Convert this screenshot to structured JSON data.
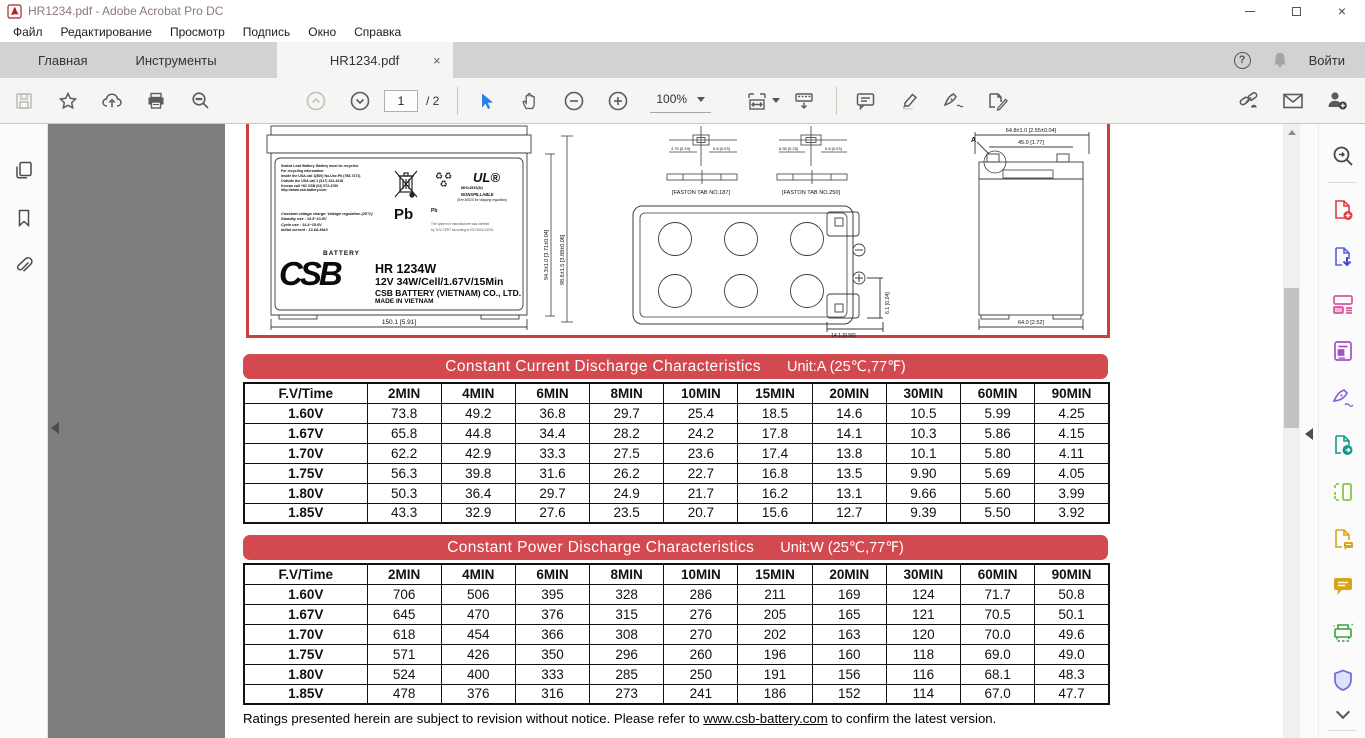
{
  "window": {
    "title": "HR1234.pdf - Adobe Acrobat Pro DC"
  },
  "icons": {
    "close_window": "×",
    "tab_close": "×",
    "help": "?"
  },
  "menu": {
    "items": [
      "Файл",
      "Редактирование",
      "Просмотр",
      "Подпись",
      "Окно",
      "Справка"
    ]
  },
  "tabbar": {
    "tabs": [
      {
        "label": "Главная"
      },
      {
        "label": "Инструменты"
      },
      {
        "label": "HR1234.pdf"
      }
    ],
    "sign_in": "Войти"
  },
  "toolbar": {
    "page_current": "1",
    "page_total": "/ 2",
    "zoom_level": "100%"
  },
  "document": {
    "drawing": {
      "label": {
        "recycle_lines": [
          "Sealed Lead Battery. Battery must be recycled.",
          "For recycling information:",
          "Inside the USA call 1(800) No-Use-Pb (768-7372)",
          "Outside the USA call 1 (817) 244-4418",
          "Korean call +82 CSB (02) 572-4760",
          "http://www.csb-battery.com"
        ],
        "charge_lines": [
          "Constant voltage charge. Voltage regulation (25°C)",
          "Standby use : 13.5~13.8V",
          "Cycle use : 14.4~15.0V",
          "Initial current : 13.6A MAX"
        ],
        "pb_trash": "Pb",
        "pb_recycle": "Pb",
        "ul_logo": "UL®",
        "ul_number": "MH14533(N)",
        "nonspillable": "NONSPILLABLE",
        "nonspillable_note": "(See MSDS for shipping regulation)",
        "tuv_note1": "The system of manufacturer was certified",
        "tuv_note2": "by TUV CERT according to ISO 9001/14001.",
        "brand": "CSB",
        "brand_upper": "BATTERY",
        "model": "HR 1234W",
        "spec": "12V 34W/Cell/1.67V/15Min",
        "company": "CSB BATTERY (VIETNAM) CO., LTD.",
        "made_in": "MADE IN VIETNAM"
      },
      "dims": {
        "front_width": "150.1 [5.91]",
        "front_height": "94.3±1.0 [3.71±0.04]",
        "total_height": "98.6±1.5 [3.88±0.06]",
        "faston_187": "[FASTON TAB NO.187]",
        "faston_250": "[FASTON TAB NO.250]",
        "d187_w": "4.75 [0.19]",
        "d187_t": "0.8 [0.03]",
        "d250_w": "6.35 [0.25]",
        "d250_t": "0.8 [0.03]",
        "top_terminal_offset": "6.1 [0.24]",
        "top_terminal_inset": "14.1 [0.56]",
        "side_width_top": "64.8±1.0 [2.55±0.04]",
        "side_lid_width": "45.0 [1.77]",
        "side_width_bottom": "64.0 [2.52]",
        "detail_a": "A"
      }
    },
    "current_table": {
      "title": "Constant Current Discharge Characteristics",
      "unit": "Unit:A (25℃,77℉)",
      "headers": [
        "F.V/Time",
        "2MIN",
        "4MIN",
        "6MIN",
        "8MIN",
        "10MIN",
        "15MIN",
        "20MIN",
        "30MIN",
        "60MIN",
        "90MIN"
      ],
      "rows": [
        {
          "fv": "1.60V",
          "values": [
            "73.8",
            "49.2",
            "36.8",
            "29.7",
            "25.4",
            "18.5",
            "14.6",
            "10.5",
            "5.99",
            "4.25"
          ]
        },
        {
          "fv": "1.67V",
          "values": [
            "65.8",
            "44.8",
            "34.4",
            "28.2",
            "24.2",
            "17.8",
            "14.1",
            "10.3",
            "5.86",
            "4.15"
          ]
        },
        {
          "fv": "1.70V",
          "values": [
            "62.2",
            "42.9",
            "33.3",
            "27.5",
            "23.6",
            "17.4",
            "13.8",
            "10.1",
            "5.80",
            "4.11"
          ]
        },
        {
          "fv": "1.75V",
          "values": [
            "56.3",
            "39.8",
            "31.6",
            "26.2",
            "22.7",
            "16.8",
            "13.5",
            "9.90",
            "5.69",
            "4.05"
          ]
        },
        {
          "fv": "1.80V",
          "values": [
            "50.3",
            "36.4",
            "29.7",
            "24.9",
            "21.7",
            "16.2",
            "13.1",
            "9.66",
            "5.60",
            "3.99"
          ]
        },
        {
          "fv": "1.85V",
          "values": [
            "43.3",
            "32.9",
            "27.6",
            "23.5",
            "20.7",
            "15.6",
            "12.7",
            "9.39",
            "5.50",
            "3.92"
          ]
        }
      ]
    },
    "power_table": {
      "title": "Constant Power Discharge Characteristics",
      "unit": "Unit:W (25℃,77℉)",
      "headers": [
        "F.V/Time",
        "2MIN",
        "4MIN",
        "6MIN",
        "8MIN",
        "10MIN",
        "15MIN",
        "20MIN",
        "30MIN",
        "60MIN",
        "90MIN"
      ],
      "rows": [
        {
          "fv": "1.60V",
          "values": [
            "706",
            "506",
            "395",
            "328",
            "286",
            "211",
            "169",
            "124",
            "71.7",
            "50.8"
          ]
        },
        {
          "fv": "1.67V",
          "values": [
            "645",
            "470",
            "376",
            "315",
            "276",
            "205",
            "165",
            "121",
            "70.5",
            "50.1"
          ]
        },
        {
          "fv": "1.70V",
          "values": [
            "618",
            "454",
            "366",
            "308",
            "270",
            "202",
            "163",
            "120",
            "70.0",
            "49.6"
          ]
        },
        {
          "fv": "1.75V",
          "values": [
            "571",
            "426",
            "350",
            "296",
            "260",
            "196",
            "160",
            "118",
            "69.0",
            "49.0"
          ]
        },
        {
          "fv": "1.80V",
          "values": [
            "524",
            "400",
            "333",
            "285",
            "250",
            "191",
            "156",
            "116",
            "68.1",
            "48.3"
          ]
        },
        {
          "fv": "1.85V",
          "values": [
            "478",
            "376",
            "316",
            "273",
            "241",
            "186",
            "152",
            "114",
            "67.0",
            "47.7"
          ]
        }
      ]
    },
    "footer": {
      "text_before": "Ratings presented herein are subject to revision without notice. Please refer to ",
      "link": "www.csb-battery.com",
      "text_after": " to confirm the latest version."
    }
  },
  "colors": {
    "accent_red": "#d2494f",
    "drawing_border_red": "#c9413f",
    "selection_blue": "#2a7fe8"
  }
}
